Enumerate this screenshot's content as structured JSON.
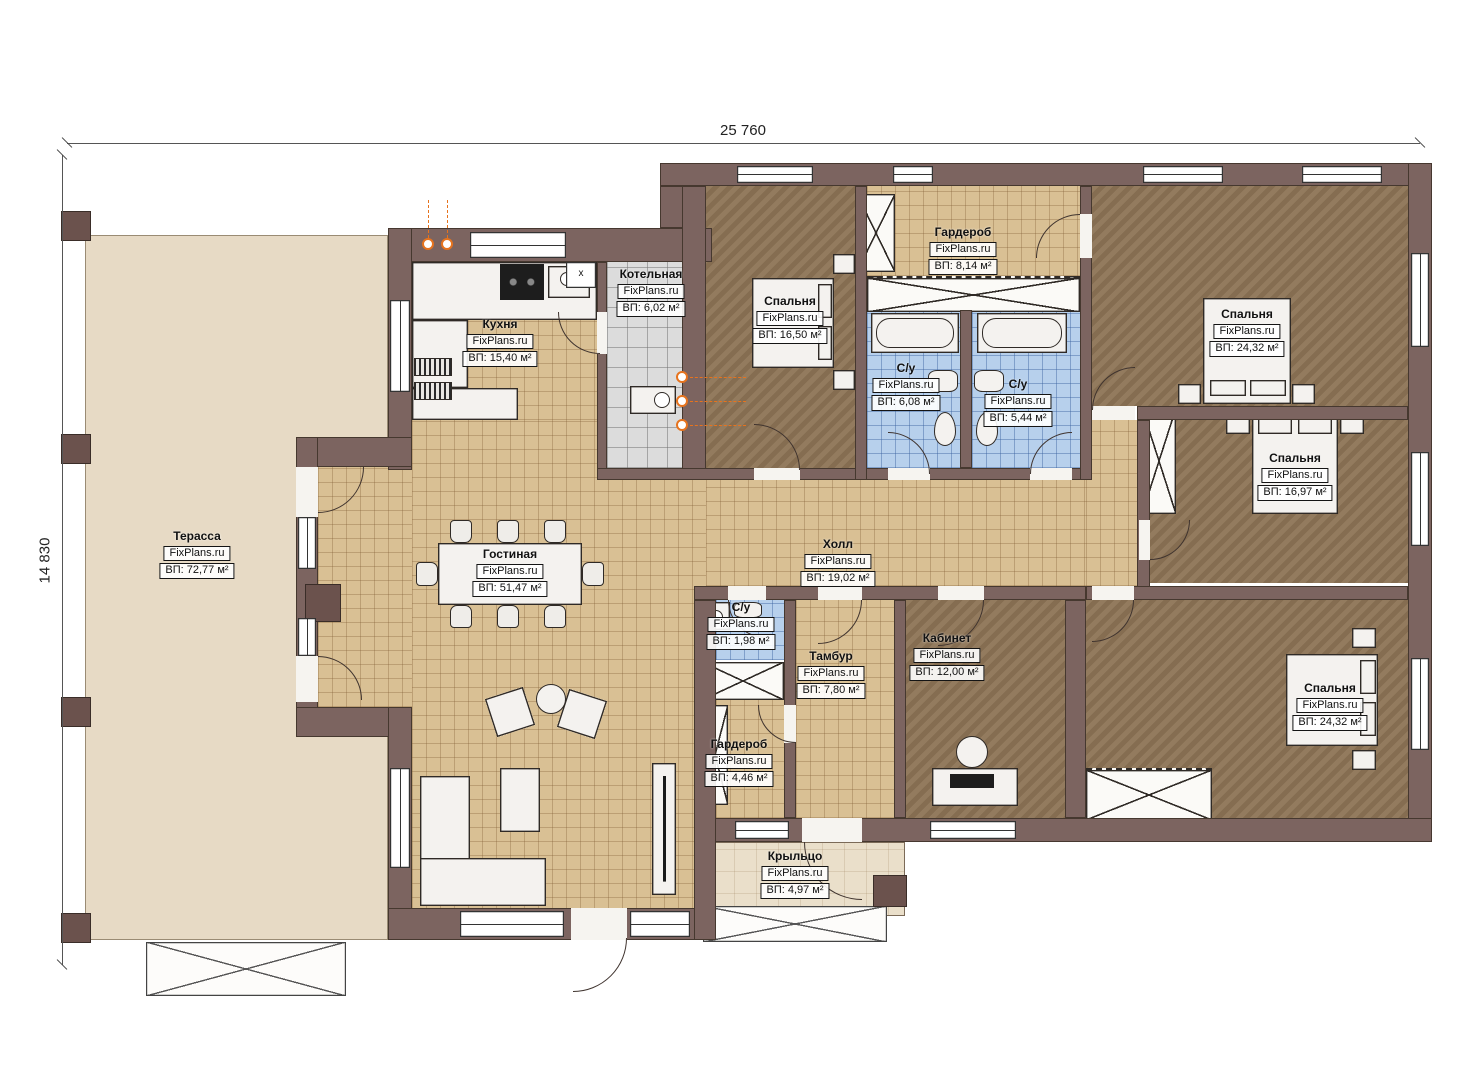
{
  "meta": {
    "brand": "FixPlans.ru"
  },
  "dimensions": {
    "width_label": "25 760",
    "height_label": "14 830"
  },
  "vent_label": "x",
  "rooms": [
    {
      "name": "Терасса",
      "area": "ВП: 72,77 м²"
    },
    {
      "name": "Кухня",
      "area": "ВП: 15,40 м²"
    },
    {
      "name": "Котельная",
      "area": "ВП: 6,02 м²"
    },
    {
      "name": "Спальня",
      "area": "ВП: 16,50 м²"
    },
    {
      "name": "Гардероб",
      "area": "ВП: 8,14 м²"
    },
    {
      "name": "С/у",
      "area": "ВП: 6,08 м²"
    },
    {
      "name": "С/у",
      "area": "ВП: 5,44 м²"
    },
    {
      "name": "Спальня",
      "area": "ВП: 24,32 м²"
    },
    {
      "name": "Спальня",
      "area": "ВП: 16,97 м²"
    },
    {
      "name": "Гостиная",
      "area": "ВП: 51,47 м²"
    },
    {
      "name": "Холл",
      "area": "ВП: 19,02 м²"
    },
    {
      "name": "С/у",
      "area": "ВП: 1,98 м²"
    },
    {
      "name": "Тамбур",
      "area": "ВП: 7,80 м²"
    },
    {
      "name": "Кабинет",
      "area": "ВП: 12,00 м²"
    },
    {
      "name": "Гардероб",
      "area": "ВП: 4,46 м²"
    },
    {
      "name": "Спальня",
      "area": "ВП: 24,32 м²"
    },
    {
      "name": "Крыльцо",
      "area": "ВП: 4,97 м²"
    }
  ]
}
